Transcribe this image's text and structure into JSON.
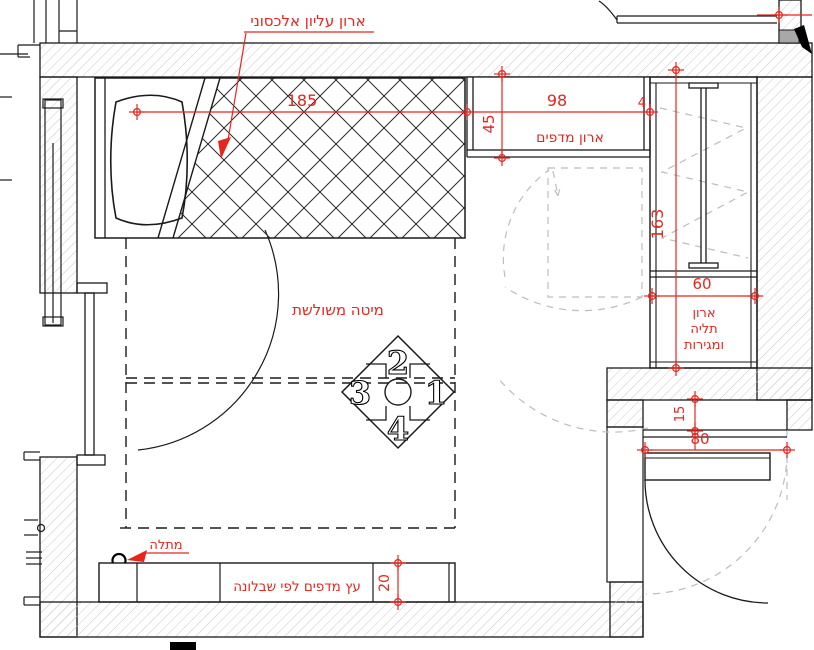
{
  "labels": {
    "upper_cabinet": "ארון עליון אלכסוני",
    "shelf_cabinet": "ארון מדפים",
    "hanging_cabinet_l1": "ארון",
    "hanging_cabinet_l2": "תליה",
    "hanging_cabinet_l3": "ומגירות",
    "bed": "מיטה משולשת",
    "hanger": "מתלה",
    "bottom_shelf": "עץ מדפים לפי שבלונה"
  },
  "dimensions": {
    "bed_length": "185",
    "shelf_cabinet_width": "98",
    "shelf_cabinet_depth": "45",
    "door_tag": "4",
    "closet_height": "163",
    "closet_width": "60",
    "entry_width": "80",
    "niche_depth": "15",
    "shelf_depth": "20"
  },
  "elevation_marker": {
    "top": "2",
    "left": "3",
    "right": "1",
    "bottom": "4"
  },
  "colors": {
    "dimension_red": "#e8251d",
    "wall_hatch_gray": "#c9c9c9",
    "door_swing_gray": "#bdbdbd",
    "line_black": "#1a1a1a"
  }
}
